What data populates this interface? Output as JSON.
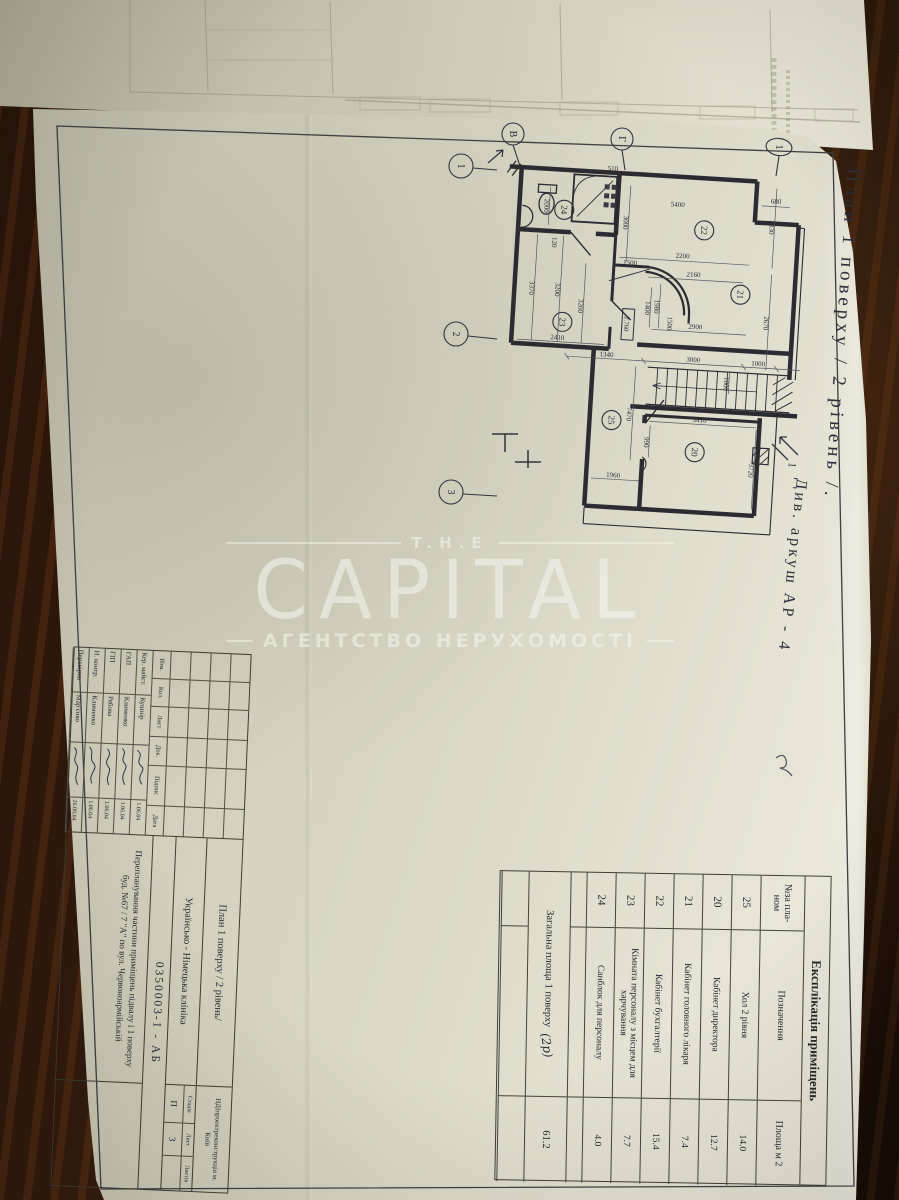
{
  "watermark": {
    "top": "T.H.E",
    "brand": "CAPITAL",
    "subtitle": "АГЕНТСТВО НЕРУХОМОСТІ"
  },
  "sheet": {
    "side_title": "План 1 поверху / 2 рівень /.",
    "see_sheet_note": "Див. аркуш АР - 4",
    "see_sheet_marker": "1"
  },
  "plan": {
    "axes_top": [
      "В",
      "Г"
    ],
    "axes_left": [
      "1",
      "2",
      "3"
    ],
    "axis_right": "1",
    "rooms": {
      "r20": "20",
      "r21": "21",
      "r22": "22",
      "r23": "23",
      "r24": "24",
      "r25": "25"
    },
    "elevation": "2.760",
    "dims": {
      "d510": "510",
      "d5400": "5400",
      "d3000a": "3000",
      "d2830": "2830",
      "d680": "680",
      "d2200": "2200",
      "d2160": "2160",
      "d2670": "2670",
      "d1980": "1980",
      "d1400": "1400",
      "d1500a": "1500",
      "d1500b": "1500",
      "d2900": "2900",
      "d1340": "1340",
      "d3000b": "3000",
      "d1000a": "1000",
      "d1000b": "1000",
      "d7470": "7470",
      "d3410": "3410",
      "d3720": "3720",
      "d1960": "1960",
      "d990": "990",
      "d2410": "2410",
      "d3200a": "3200",
      "d3200b": "3200",
      "d3370": "3370",
      "d120": "120",
      "d2000": "2000"
    }
  },
  "explication": {
    "title": "Експлікація приміщень",
    "columns": {
      "num": "№за пла-ном",
      "name": "Позначення",
      "area": "Площа м 2"
    },
    "rows": [
      {
        "num": "25",
        "name": "Хол 2 рівня",
        "area": "14.0"
      },
      {
        "num": "20",
        "name": "Кабінет директора",
        "area": "12.7"
      },
      {
        "num": "21",
        "name": "Кабінет головного лікаря",
        "area": "7.4"
      },
      {
        "num": "22",
        "name": "Кабінет бухгалтерії",
        "area": "15.4"
      },
      {
        "num": "23",
        "name": "Кімната персоналу з місцем для харчування",
        "area": "7.7"
      },
      {
        "num": "24",
        "name": "Санблок для персоналу",
        "area": "4.0"
      }
    ],
    "total": {
      "label": "Загальна площа 1 поверху",
      "note": "(2р)",
      "value": "61.2"
    }
  },
  "stamp": {
    "log_columns": [
      "Изм.",
      "Кол.",
      "Лист",
      "Док.",
      "Підпис",
      "Дата"
    ],
    "signers": [
      {
        "role": "Кер. майст.",
        "name": "Кушнір",
        "date": "1.06.04"
      },
      {
        "role": "ГАП",
        "name": "Клименко",
        "date": "1.06.04"
      },
      {
        "role": "ГІП",
        "name": "Рябова",
        "date": "1.06.04"
      },
      {
        "role": "Н. контр.",
        "name": "Клименко",
        "date": "1.06.04"
      },
      {
        "role": "Перевірив",
        "name": "Мар'єнко",
        "date": "26.08.04"
      }
    ],
    "sheet_name": "План 1 поверху / 2 рівень/",
    "organization": "НДІпроектреконструкція м. Київ",
    "object_name": "Українсько - Німецька клініка",
    "stage": {
      "label": "Стадія",
      "value": "П"
    },
    "sheet_col": {
      "label": "Лист",
      "value": "3"
    },
    "sheets_col": {
      "label": "Листів",
      "value": ""
    },
    "code": "0350003-1 - АБ",
    "project": "Перепланування частини приміщень підвалу і 1 поверху буд. №67 / 7 \"А\" по вул. Червоноармійській"
  }
}
